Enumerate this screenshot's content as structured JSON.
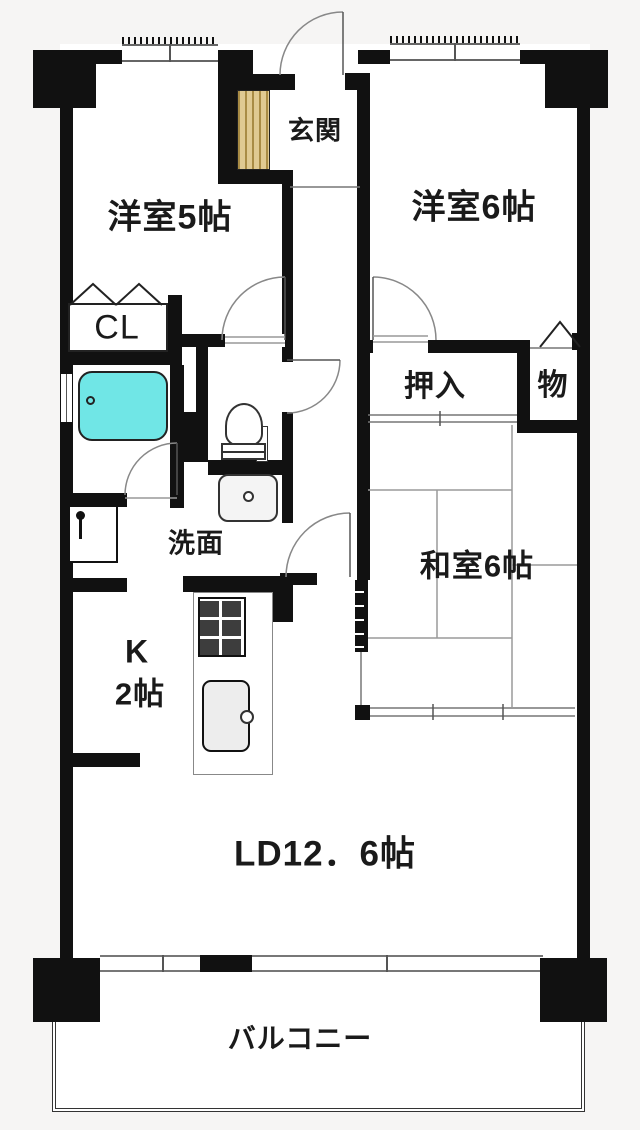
{
  "plan_title": "apartment-floor-plan",
  "rooms": {
    "yoshitsu5": {
      "label": "洋室5帖"
    },
    "yoshitsu6": {
      "label": "洋室6帖"
    },
    "genkan": {
      "label": "玄関"
    },
    "closet": {
      "label": "CL"
    },
    "oshiire": {
      "label": "押入"
    },
    "mono": {
      "label": "物"
    },
    "washitsu6": {
      "label": "和室6帖"
    },
    "senmen": {
      "label": "洗面"
    },
    "kitchen": {
      "label_line1": "K",
      "label_line2": "2帖"
    },
    "ld": {
      "label": "LD12．6帖"
    },
    "balcony": {
      "label": "バルコニー"
    }
  },
  "fixtures": {
    "bathtub": "bathtub",
    "toilet": "toilet",
    "wash_basin": "wash-basin",
    "washing_machine_pan": "washing-machine-pan",
    "stove": "gas-stove",
    "kitchen_sink": "kitchen-sink",
    "shoe_cabinet": "shoe-cabinet"
  },
  "colors": {
    "wall": "#111111",
    "bathtub": "#70e6e6",
    "shoe_cabinet": "#e0ca92",
    "shoe_cabinet_stripe": "#a98c45",
    "thin_line": "#777777",
    "floor": "#ffffff"
  }
}
